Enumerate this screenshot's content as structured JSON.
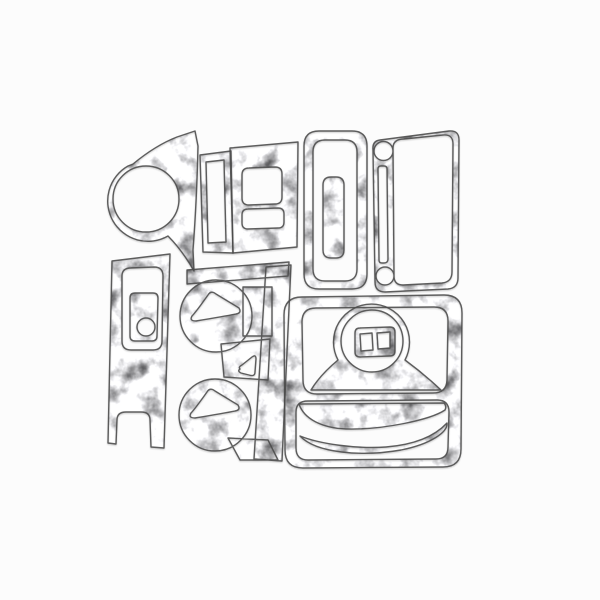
{
  "scene": {
    "type": "product-photo",
    "description": "Overhead product photo of an 11-piece burl aluminum car dashboard trim kit, loose die-cut pieces arranged on a plain white background",
    "background_color": "#fcfcfc",
    "piece_base_color": "#c4c4c4",
    "outline_color": "#4a4a4a",
    "texture_style": "mottled silver burl-aluminum pattern",
    "piece_count": 11,
    "pieces": [
      {
        "name": "gauge-cluster-ring-trim",
        "description": "Comma-shaped bezel with large round gauge cutout, upper left"
      },
      {
        "name": "side-switch-strip-bezel",
        "description": "Narrow slanted bezel with a vertical slot cutout"
      },
      {
        "name": "power-window-switch-panel",
        "description": "Rectangular panel with two rounded switch cutouts"
      },
      {
        "name": "handbrake-lever-bezel",
        "description": "Tall rounded bezel with U-shaped slot and solid center bar"
      },
      {
        "name": "glovebox-bezel",
        "description": "Wide bezel with two round holes, a thin slot and one large rounded opening"
      },
      {
        "name": "console-side-trim",
        "description": "Vertical forked trim with switch-plate window and round hole"
      },
      {
        "name": "air-vent-panel",
        "description": "Panel with two round vent rings containing rounded-triangle cutouts, joined to top and side bars"
      },
      {
        "name": "shifter-console-panel",
        "description": "Large rounded panel frame with two big openings"
      },
      {
        "name": "shifter-boot-surround",
        "description": "Bell-shaped surround with ring opening and twin-rocker switch plate"
      },
      {
        "name": "upper-curve-trim",
        "description": "Curved swoosh strip inside the lower opening"
      },
      {
        "name": "lower-curve-trim",
        "description": "Curved crescent strip at the bottom of the lower opening"
      }
    ]
  }
}
